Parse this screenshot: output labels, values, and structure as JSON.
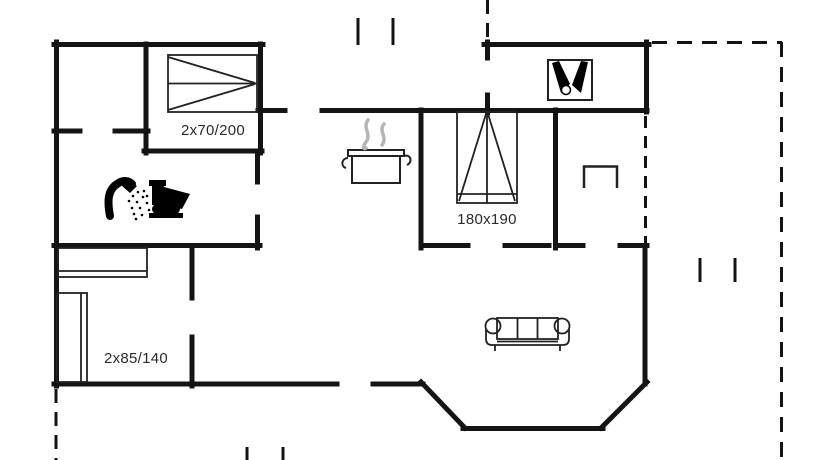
{
  "document": {
    "type": "holiday-home-floor-plan",
    "background_color": "#ffffff"
  },
  "colors": {
    "wall": "#141414",
    "furniture_line": "#222222",
    "steam_gray": "#b5b5b5",
    "label_text": "#2b2b2b"
  },
  "labels": {
    "bed_double": "2x70/200",
    "bed_master": "180x190",
    "bed_bunk": "2x85/140"
  },
  "icons": [
    {
      "name": "double-bed-icon",
      "meaning": "double bed 2x70/200 in top-left bedroom"
    },
    {
      "name": "shower-icon",
      "meaning": "shower head with spray in bathroom"
    },
    {
      "name": "toilet-icon",
      "meaning": "toilet in bathroom"
    },
    {
      "name": "cooking-pot-icon",
      "meaning": "steaming pot marking the kitchen"
    },
    {
      "name": "steam-icon",
      "meaning": "steam waves above pot"
    },
    {
      "name": "wine-bottles-icon",
      "meaning": "two bottles and glass in annex box"
    },
    {
      "name": "bed-180x190-icon",
      "meaning": "double bed 180x190 in middle bedroom"
    },
    {
      "name": "bunk-beds-icon",
      "meaning": "two children beds 2x85/140 in lower-left bedroom"
    },
    {
      "name": "sofa-icon",
      "meaning": "three-seat sofa in living room"
    },
    {
      "name": "step-niche-icon",
      "meaning": "entrance step marker in porch"
    }
  ],
  "structure": {
    "dashed_outlines": [
      "terrace-right",
      "terrace-bottom-left",
      "porch-open-side",
      "courtyard-top"
    ],
    "bay_window": "angled bay on living room south wall"
  }
}
